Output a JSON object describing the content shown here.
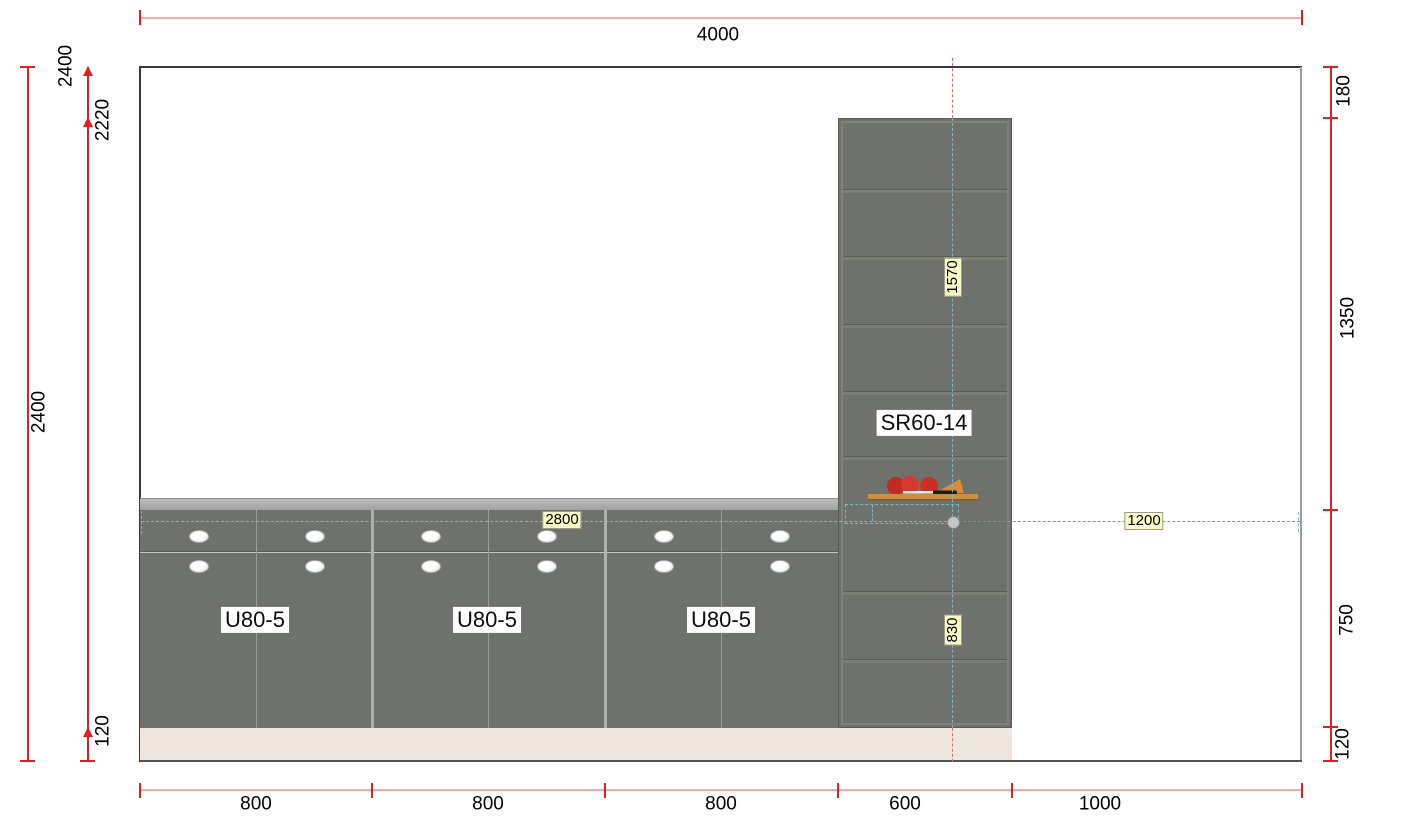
{
  "dims": {
    "top": {
      "total": "4000"
    },
    "left": {
      "overall": "2400",
      "running": [
        "2400",
        "2220",
        "120"
      ]
    },
    "right": [
      "180",
      "1350",
      "750",
      "120"
    ],
    "bottom": [
      "800",
      "800",
      "800",
      "600",
      "1000"
    ]
  },
  "cabinets": {
    "base": [
      {
        "label": "U80-5"
      },
      {
        "label": "U80-5"
      },
      {
        "label": "U80-5"
      }
    ],
    "tall": {
      "label": "SR60-14"
    }
  },
  "editable_dims": {
    "counter_width": "2800",
    "tall_upper_height": "1570",
    "tall_lower_height": "830",
    "right_offset": "1200"
  },
  "colors": {
    "cabinet_front": "#6F716C",
    "countertop": "#A9A9A9",
    "plinth": "#EFE6E0",
    "dimension_red": "#E02020",
    "dimension_pink": "#F6ABA7",
    "guide_teal": "#7ABAC4",
    "guide_red": "#E06A6A",
    "highlight_yellow": "#FBF9C5"
  }
}
